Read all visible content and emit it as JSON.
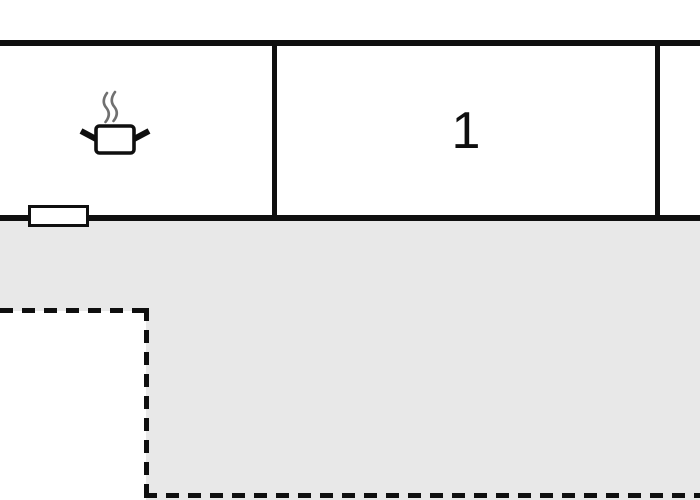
{
  "floorplan": {
    "rooms": {
      "kitchen": {
        "label": "",
        "feature_icon": "cooking-pot-with-steam"
      },
      "room1": {
        "label": "1"
      },
      "room_right": {
        "label": ""
      }
    },
    "terrace": {
      "label": ""
    },
    "symbols": {
      "window": "window-symbol",
      "stove": "cooking-pot-with-steam"
    }
  },
  "colors": {
    "wall": "#0f0f0f",
    "terrace": "#e8e8e8",
    "steam": "#707070",
    "background": "#ffffff"
  }
}
